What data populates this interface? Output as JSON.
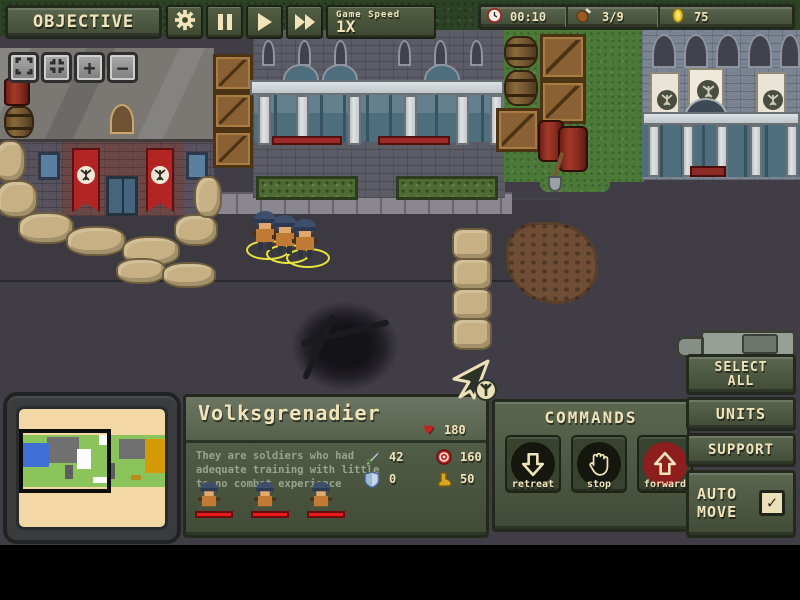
{
  "top_bar": {
    "objective": "OBJECTIVE",
    "game_speed_label": "Game Speed",
    "game_speed_value": "1X",
    "timer": "00:10",
    "food": "3/9",
    "coins": "75"
  },
  "map_controls": {
    "zoom_in": "+",
    "zoom_out": "−"
  },
  "unit_panel": {
    "title": "Volksgrenadier",
    "hp": "180",
    "description_lines": [
      "They are soldiers who had",
      "adequate training with little",
      "to no combat experience"
    ],
    "stats": [
      {
        "icon": "sword-icon",
        "value": "42"
      },
      {
        "icon": "target-icon",
        "value": "160"
      },
      {
        "icon": "shield-icon",
        "value": "0"
      },
      {
        "icon": "boot-icon",
        "value": "50"
      }
    ],
    "unit_count": 3
  },
  "commands_panel": {
    "title": "COMMANDS",
    "retreat": "retreat",
    "stop": "stop",
    "forward": "forward"
  },
  "right_panel": {
    "select_line1": "SELECT",
    "select_line2": "ALL",
    "units": "UNITS",
    "support": "SUPPORT",
    "auto_line1": "AUTO",
    "auto_line2": "MOVE",
    "auto_move_check": "✓"
  },
  "icons": {
    "gear-icon": "settings gear",
    "pause-icon": "pause bars",
    "play-icon": "play triangle",
    "fast-forward-icon": "double triangle",
    "clock-icon": "timer clock",
    "drumstick-icon": "food / grenade supply",
    "coin-icon": "gold coin",
    "heart-icon": "hit points",
    "sword-icon": "attack",
    "target-icon": "range",
    "shield-icon": "armor",
    "boot-icon": "speed",
    "retreat-arrow-icon": "down arrow",
    "stop-hand-icon": "open hand",
    "forward-arrow-icon": "up arrow",
    "expand-icon": "maximize view",
    "contract-icon": "reset view",
    "cursor-icon": "pointer with faction emblem"
  },
  "colors": {
    "hud_green": "#4c5741",
    "cream": "#f1e4bb",
    "banner_red": "#b32525",
    "minimap_bg": "#f3d8a6",
    "selection_yellow": "#e6e33c",
    "forward_red": "#8e1d1d",
    "health_red": "#e81c1c"
  }
}
